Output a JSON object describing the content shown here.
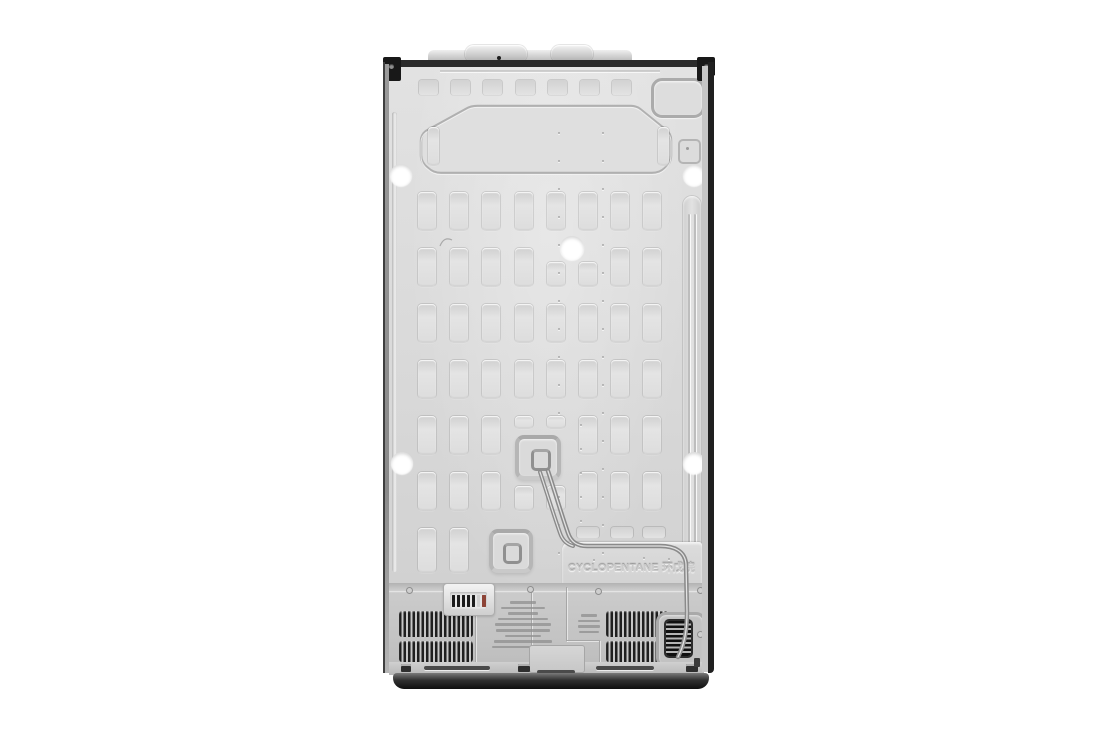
{
  "scene": {
    "description": "rear-view-of-refrigerator-back-panel",
    "background_color": "#ffffff"
  },
  "embossed": {
    "refrigerant_text": "CYCLOPENTANE 环戊烷"
  },
  "colors": {
    "panel": "#d9d9d9",
    "top_edge": "#2b2b2b",
    "base": "#101010",
    "vent_slat": "#1f1f1f",
    "pipe": "#8a8a8a",
    "hole": "#ffffff",
    "label_bar_dark": "#1b1b1b",
    "label_bar_red": "#8d4437"
  },
  "label_plate": {
    "bar_colors": [
      "#1b1b1b",
      "#1b1b1b",
      "#1b1b1b",
      "#1b1b1b",
      "#1b1b1b",
      "#cfcfcf",
      "#8d4437"
    ]
  }
}
